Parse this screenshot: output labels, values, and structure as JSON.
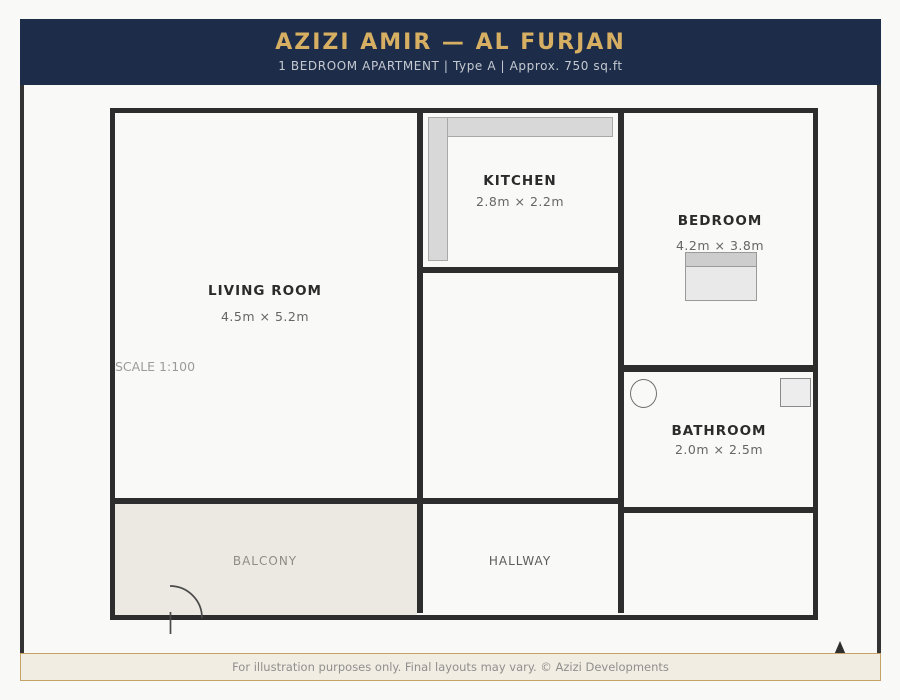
{
  "header": {
    "title": "AZIZI AMIR — AL FURJAN",
    "subtitle": "1 BEDROOM APARTMENT | Type A | Approx. 750 sq.ft"
  },
  "plan": {
    "scale_label": "SCALE 1:100",
    "rooms": [
      {
        "name": "LIVING ROOM",
        "dims": "4.5m × 5.2m"
      },
      {
        "name": "KITCHEN",
        "dims": "2.8m × 2.2m"
      },
      {
        "name": "BEDROOM",
        "dims": "4.2m × 3.8m"
      },
      {
        "name": "BATHROOM",
        "dims": "2.0m × 2.5m"
      },
      {
        "name": "BALCONY"
      },
      {
        "name": "HALLWAY"
      }
    ],
    "fixtures": [
      "kitchen-counter",
      "bed",
      "toilet",
      "washbasin",
      "door-swing",
      "north-arrow"
    ]
  },
  "footer": {
    "text": "For illustration purposes only. Final layouts may vary. © Azizi Developments"
  },
  "colors": {
    "header_bg": "#1d2c48",
    "title_gold": "#d6af62",
    "subtitle_text": "#c5cad2",
    "wall": "#2d2d2d",
    "balcony_fill": "#ece9e2",
    "footer_bg": "#f2ede2",
    "footer_border": "#c5a265",
    "page_bg": "#f9f9f7"
  }
}
